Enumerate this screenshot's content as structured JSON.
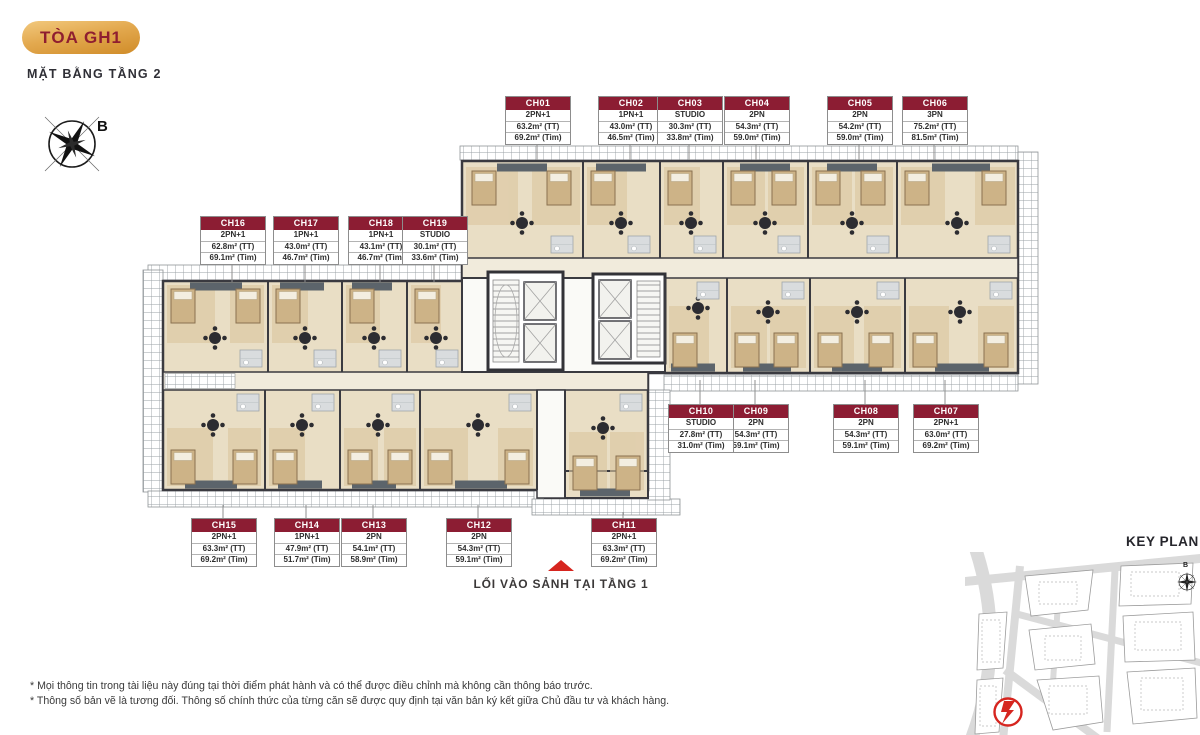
{
  "header": {
    "building": "TÒA GH1",
    "subtitle": "MẶT BẰNG TẦNG 2",
    "compass_label": "B"
  },
  "units": [
    {
      "id": "CH01",
      "type": "2PN+1",
      "area_tt": "63.2m² (TT)",
      "area_tim": "69.2m² (Tim)"
    },
    {
      "id": "CH02",
      "type": "1PN+1",
      "area_tt": "43.0m² (TT)",
      "area_tim": "46.5m² (Tim)"
    },
    {
      "id": "CH03",
      "type": "STUDIO",
      "area_tt": "30.3m² (TT)",
      "area_tim": "33.8m² (Tim)"
    },
    {
      "id": "CH04",
      "type": "2PN",
      "area_tt": "54.3m² (TT)",
      "area_tim": "59.0m² (Tim)"
    },
    {
      "id": "CH05",
      "type": "2PN",
      "area_tt": "54.2m² (TT)",
      "area_tim": "59.0m² (Tim)"
    },
    {
      "id": "CH06",
      "type": "3PN",
      "area_tt": "75.2m² (TT)",
      "area_tim": "81.5m² (Tim)"
    },
    {
      "id": "CH07",
      "type": "2PN+1",
      "area_tt": "63.0m² (TT)",
      "area_tim": "69.2m² (Tim)"
    },
    {
      "id": "CH08",
      "type": "2PN",
      "area_tt": "54.3m² (TT)",
      "area_tim": "59.1m² (Tim)"
    },
    {
      "id": "CH09",
      "type": "2PN",
      "area_tt": "54.3m² (TT)",
      "area_tim": "59.1m² (Tim)"
    },
    {
      "id": "CH10",
      "type": "STUDIO",
      "area_tt": "27.8m² (TT)",
      "area_tim": "31.0m² (Tim)"
    },
    {
      "id": "CH11",
      "type": "2PN+1",
      "area_tt": "63.3m² (TT)",
      "area_tim": "69.2m² (Tim)"
    },
    {
      "id": "CH12",
      "type": "2PN",
      "area_tt": "54.3m² (TT)",
      "area_tim": "59.1m² (Tim)"
    },
    {
      "id": "CH13",
      "type": "2PN",
      "area_tt": "54.1m² (TT)",
      "area_tim": "58.9m² (Tim)"
    },
    {
      "id": "CH14",
      "type": "1PN+1",
      "area_tt": "47.9m² (TT)",
      "area_tim": "51.7m² (Tim)"
    },
    {
      "id": "CH15",
      "type": "2PN+1",
      "area_tt": "63.3m² (TT)",
      "area_tim": "69.2m² (Tim)"
    },
    {
      "id": "CH16",
      "type": "2PN+1",
      "area_tt": "62.8m² (TT)",
      "area_tim": "69.1m² (Tim)"
    },
    {
      "id": "CH17",
      "type": "1PN+1",
      "area_tt": "43.0m² (TT)",
      "area_tim": "46.7m² (Tim)"
    },
    {
      "id": "CH18",
      "type": "1PN+1",
      "area_tt": "43.1m² (TT)",
      "area_tim": "46.7m² (Tim)"
    },
    {
      "id": "CH19",
      "type": "STUDIO",
      "area_tt": "30.1m² (TT)",
      "area_tim": "33.6m² (Tim)"
    }
  ],
  "entrance": {
    "label": "LỐI VÀO SẢNH TẠI TẦNG 1"
  },
  "key_plan": {
    "title": "KEY PLAN",
    "compass_label": "B"
  },
  "footnotes": [
    "* Mọi thông tin trong tài liệu này đúng tại thời điểm phát hành và có thể được điều chỉnh mà không cần thông báo trước.",
    "* Thông số bản vẽ là tương đối. Thông số chính thức của từng căn sẽ được quy định tại văn bản ký kết giữa Chủ đầu tư và khách hàng."
  ],
  "colors": {
    "label_header": "#8c1d33",
    "badge_gold": "#d9952f",
    "entrance_red": "#d6251f",
    "floor_beige": "#e9dec5",
    "wall_dark": "#3a3a40"
  }
}
